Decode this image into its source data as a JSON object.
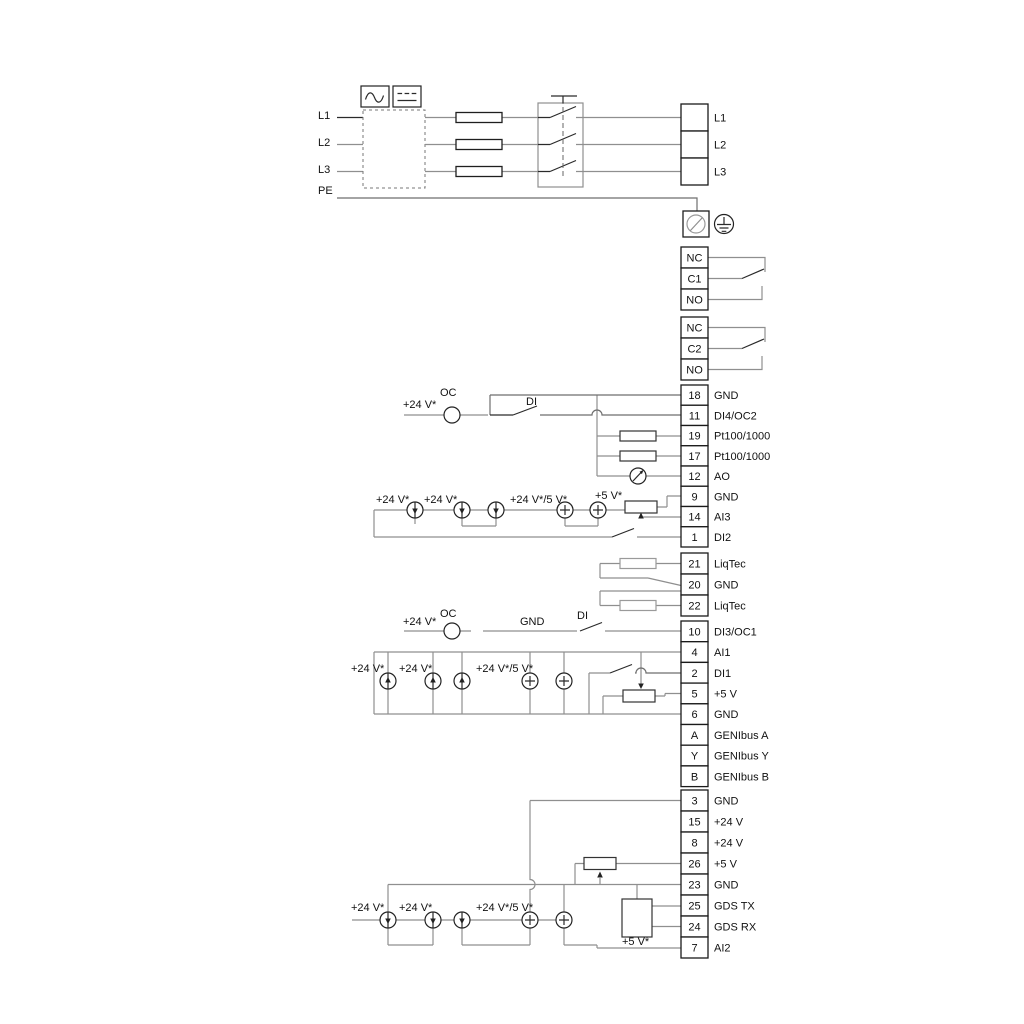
{
  "power_section": {
    "input_lines": [
      "L1",
      "L2",
      "L3",
      "PE"
    ],
    "output_terminals": [
      "L1",
      "L2",
      "L3"
    ]
  },
  "relays": {
    "relay1_pins": [
      "NC",
      "C1",
      "NO"
    ],
    "relay2_pins": [
      "NC",
      "C2",
      "NO"
    ]
  },
  "io_strips": {
    "strip1": [
      {
        "pin": "18",
        "label": "GND"
      },
      {
        "pin": "11",
        "label": "DI4/OC2"
      },
      {
        "pin": "19",
        "label": "Pt100/1000"
      },
      {
        "pin": "17",
        "label": "Pt100/1000"
      },
      {
        "pin": "12",
        "label": "AO"
      },
      {
        "pin": "9",
        "label": "GND"
      },
      {
        "pin": "14",
        "label": "AI3"
      },
      {
        "pin": "1",
        "label": "DI2"
      }
    ],
    "liqtec": [
      {
        "pin": "21",
        "label": "LiqTec"
      },
      {
        "pin": "20",
        "label": "GND"
      },
      {
        "pin": "22",
        "label": "LiqTec"
      }
    ],
    "strip2": [
      {
        "pin": "10",
        "label": "DI3/OC1"
      },
      {
        "pin": "4",
        "label": "AI1"
      },
      {
        "pin": "2",
        "label": "DI1"
      },
      {
        "pin": "5",
        "label": "+5 V"
      },
      {
        "pin": "6",
        "label": "GND"
      },
      {
        "pin": "A",
        "label": "GENIbus A"
      },
      {
        "pin": "Y",
        "label": "GENIbus Y"
      },
      {
        "pin": "B",
        "label": "GENIbus B"
      }
    ],
    "strip3": [
      {
        "pin": "3",
        "label": "GND"
      },
      {
        "pin": "15",
        "label": "+24 V"
      },
      {
        "pin": "8",
        "label": "+24 V"
      },
      {
        "pin": "26",
        "label": "+5 V"
      },
      {
        "pin": "23",
        "label": "GND"
      },
      {
        "pin": "25",
        "label": "GDS TX"
      },
      {
        "pin": "24",
        "label": "GDS RX"
      },
      {
        "pin": "7",
        "label": "AI2"
      }
    ]
  },
  "circuits": {
    "di4": {
      "supply": "+24 V*",
      "oc": "OC",
      "di": "DI"
    },
    "ai3": {
      "s1": "+24 V*",
      "s2": "+24 V*",
      "s3": "+24 V*/5 V*",
      "s4": "+5 V*"
    },
    "di3": {
      "supply": "+24 V*",
      "oc": "OC",
      "gnd": "GND",
      "di": "DI"
    },
    "ai1": {
      "s1": "+24 V*",
      "s2": "+24 V*",
      "s3": "+24 V*/5 V*"
    },
    "ai2": {
      "s1": "+24 V*",
      "s2": "+24 V*",
      "s3": "+24 V*/5 V*",
      "s4": "+5 V*"
    }
  },
  "icons": [
    "ac-symbol",
    "dc-symbol",
    "fuse",
    "main-switch",
    "pe-terminal",
    "protective-earth",
    "open-collector",
    "current-source",
    "resistor",
    "potentiometer",
    "analog-meter",
    "switch-contact",
    "gds-sensor-box"
  ],
  "colors": {
    "wire_gray": "#8f8f8f",
    "line_black": "#1f1f1f",
    "background": "#ffffff"
  }
}
